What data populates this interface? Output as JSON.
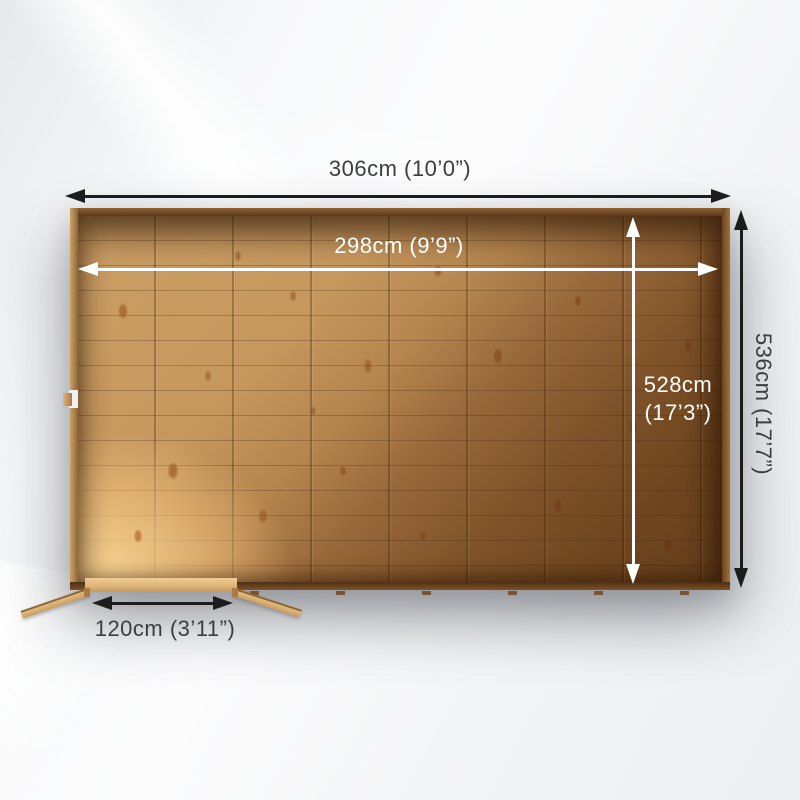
{
  "diagram": {
    "type": "shed-floor-plan-top-view",
    "labels": {
      "outer_width": "306cm (10’0”)",
      "inner_width": "298cm (9’9”)",
      "inner_depth_line1": "528cm",
      "inner_depth_line2": "(17’3”)",
      "outer_depth": "536cm (17’7”)",
      "door_width": "120cm (3’11”)"
    },
    "colors": {
      "dimension_line_dark": "#1c1c1c",
      "dimension_text_dark": "#3d3d3d",
      "dimension_line_light": "#ffffff",
      "floor_wood_light": "#cb9e64",
      "floor_wood_dark": "#653f1c",
      "wall_brown": "#5c391b",
      "door_wood": "#e3bd82",
      "background": "#f4f5f6"
    }
  }
}
